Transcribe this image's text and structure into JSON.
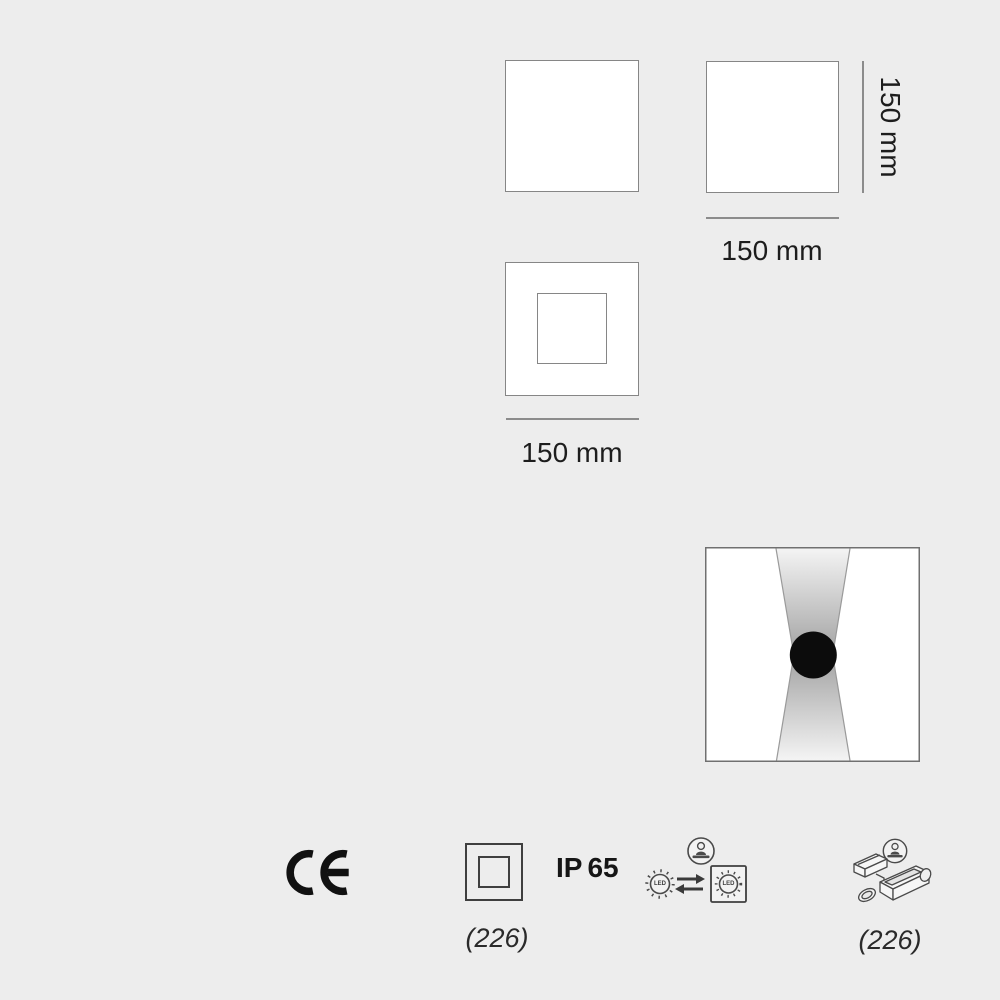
{
  "page": {
    "background_color": "#ededed",
    "line_color": "#868686",
    "text_color": "#1d1d1d",
    "beam_gray": "#a8a8a8",
    "spot_black": "#0c0c0c"
  },
  "views": {
    "top_view": {
      "description": "plain square outline"
    },
    "front_view": {
      "width_label": "150 mm",
      "height_label": "150 mm"
    },
    "frame_view": {
      "width_label": "150 mm"
    }
  },
  "light_distribution": {
    "description": "square wall fixture with up and down light beams and central black spot"
  },
  "footer": {
    "ce_mark": "CE",
    "class2_code": "(226)",
    "ip_prefix": "IP",
    "ip_value": "65",
    "led_label": "LED",
    "accessory_code": "(226)"
  },
  "icons": {
    "ce_mark": "ce-mark-icon",
    "class2": "double-insulation-square-icon",
    "led_swap": "replaceable-led-icon",
    "installer": "installer-person-icon",
    "accessory_box": "recessed-housing-kit-icon",
    "light_beam": "up-down-beam-icon"
  }
}
